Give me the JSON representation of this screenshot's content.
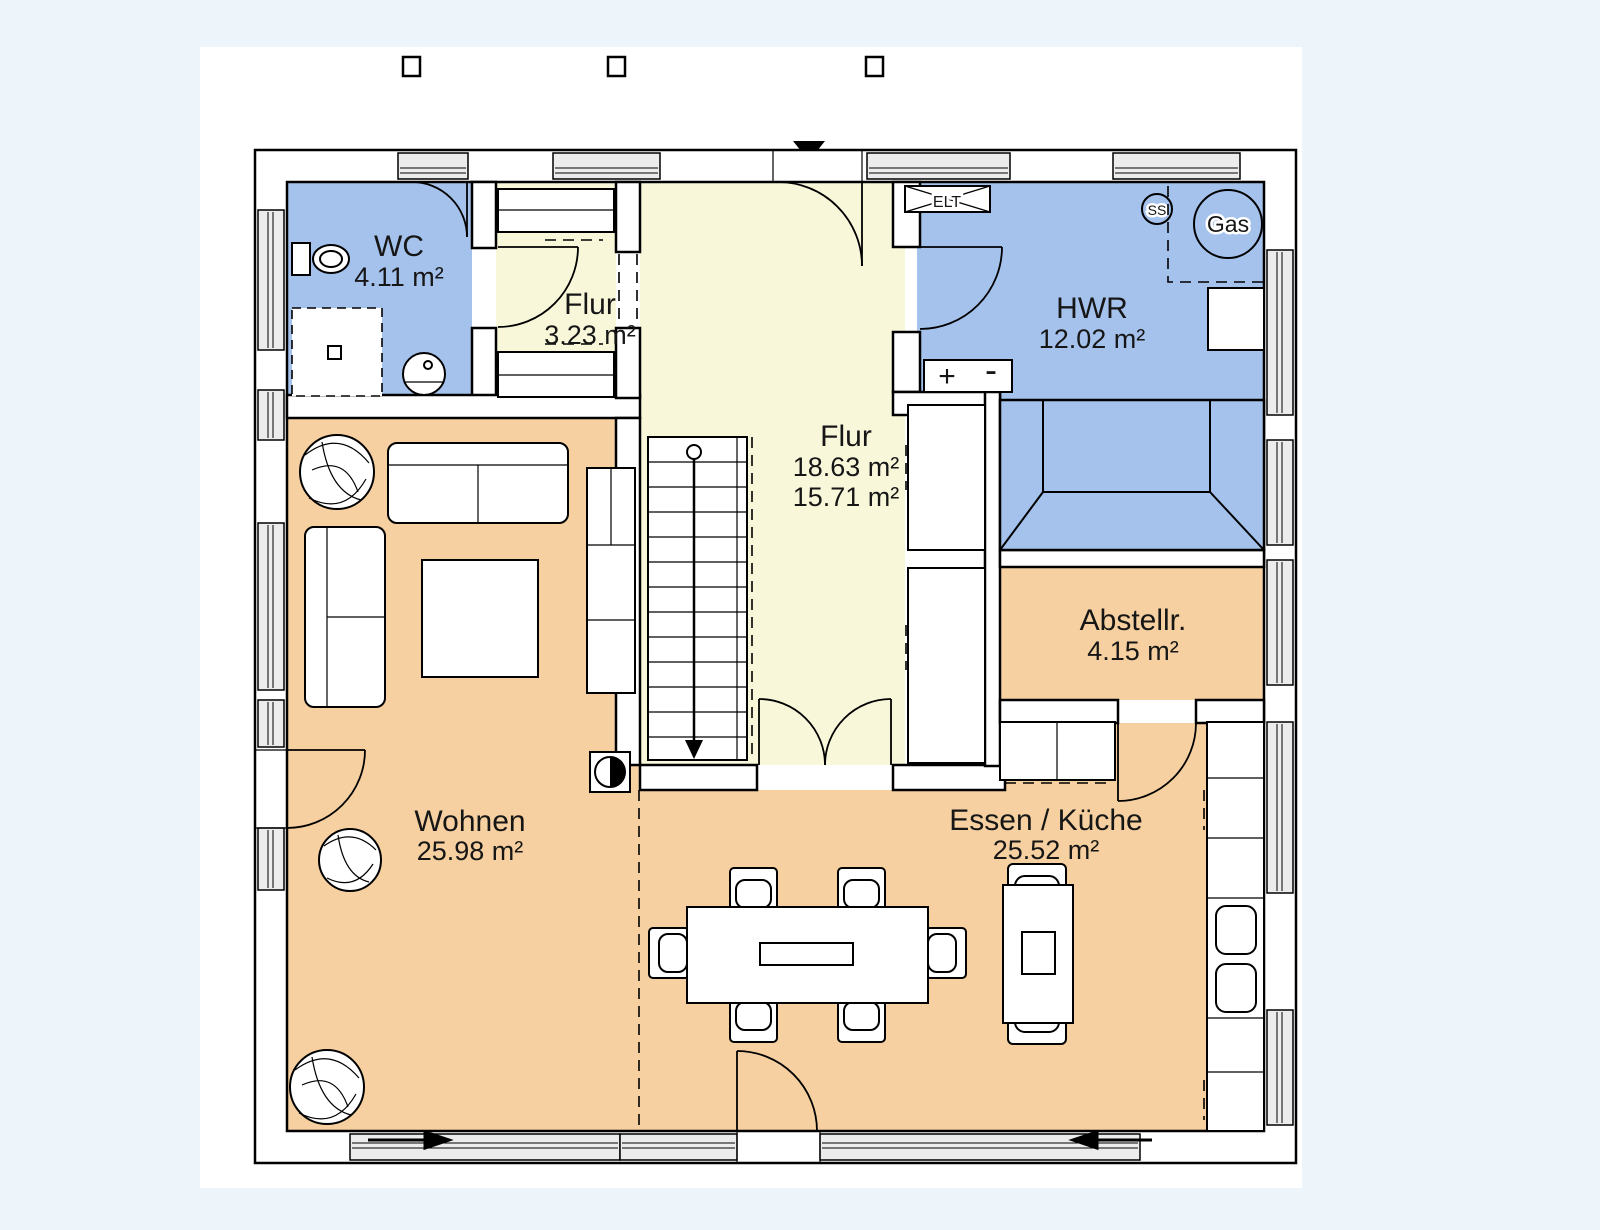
{
  "rooms": {
    "wc": {
      "name": "WC",
      "area": "4.11 m²"
    },
    "flur_klein": {
      "name": "Flur",
      "area": "3.23 m²"
    },
    "flur": {
      "name": "Flur",
      "area": "18.63 m²",
      "area2": "15.71 m²"
    },
    "hwr": {
      "name": "HWR",
      "area": "12.02 m²"
    },
    "abstellraum": {
      "name": "Abstellr.",
      "area": "4.15 m²"
    },
    "wohnen": {
      "name": "Wohnen",
      "area": "25.98 m²"
    },
    "essen_kueche": {
      "name": "Essen / Küche",
      "area": "25.52 m²"
    }
  },
  "symbols": {
    "elt": "ELT",
    "ss": "SS",
    "gas": "Gas",
    "plus": "+",
    "minus": "-"
  },
  "colors": {
    "wet_room": "#a5c2ec",
    "hall": "#f9f7da",
    "living": "#f6d0a0",
    "page": "#edf5fb",
    "canvas": "#ffffff"
  }
}
